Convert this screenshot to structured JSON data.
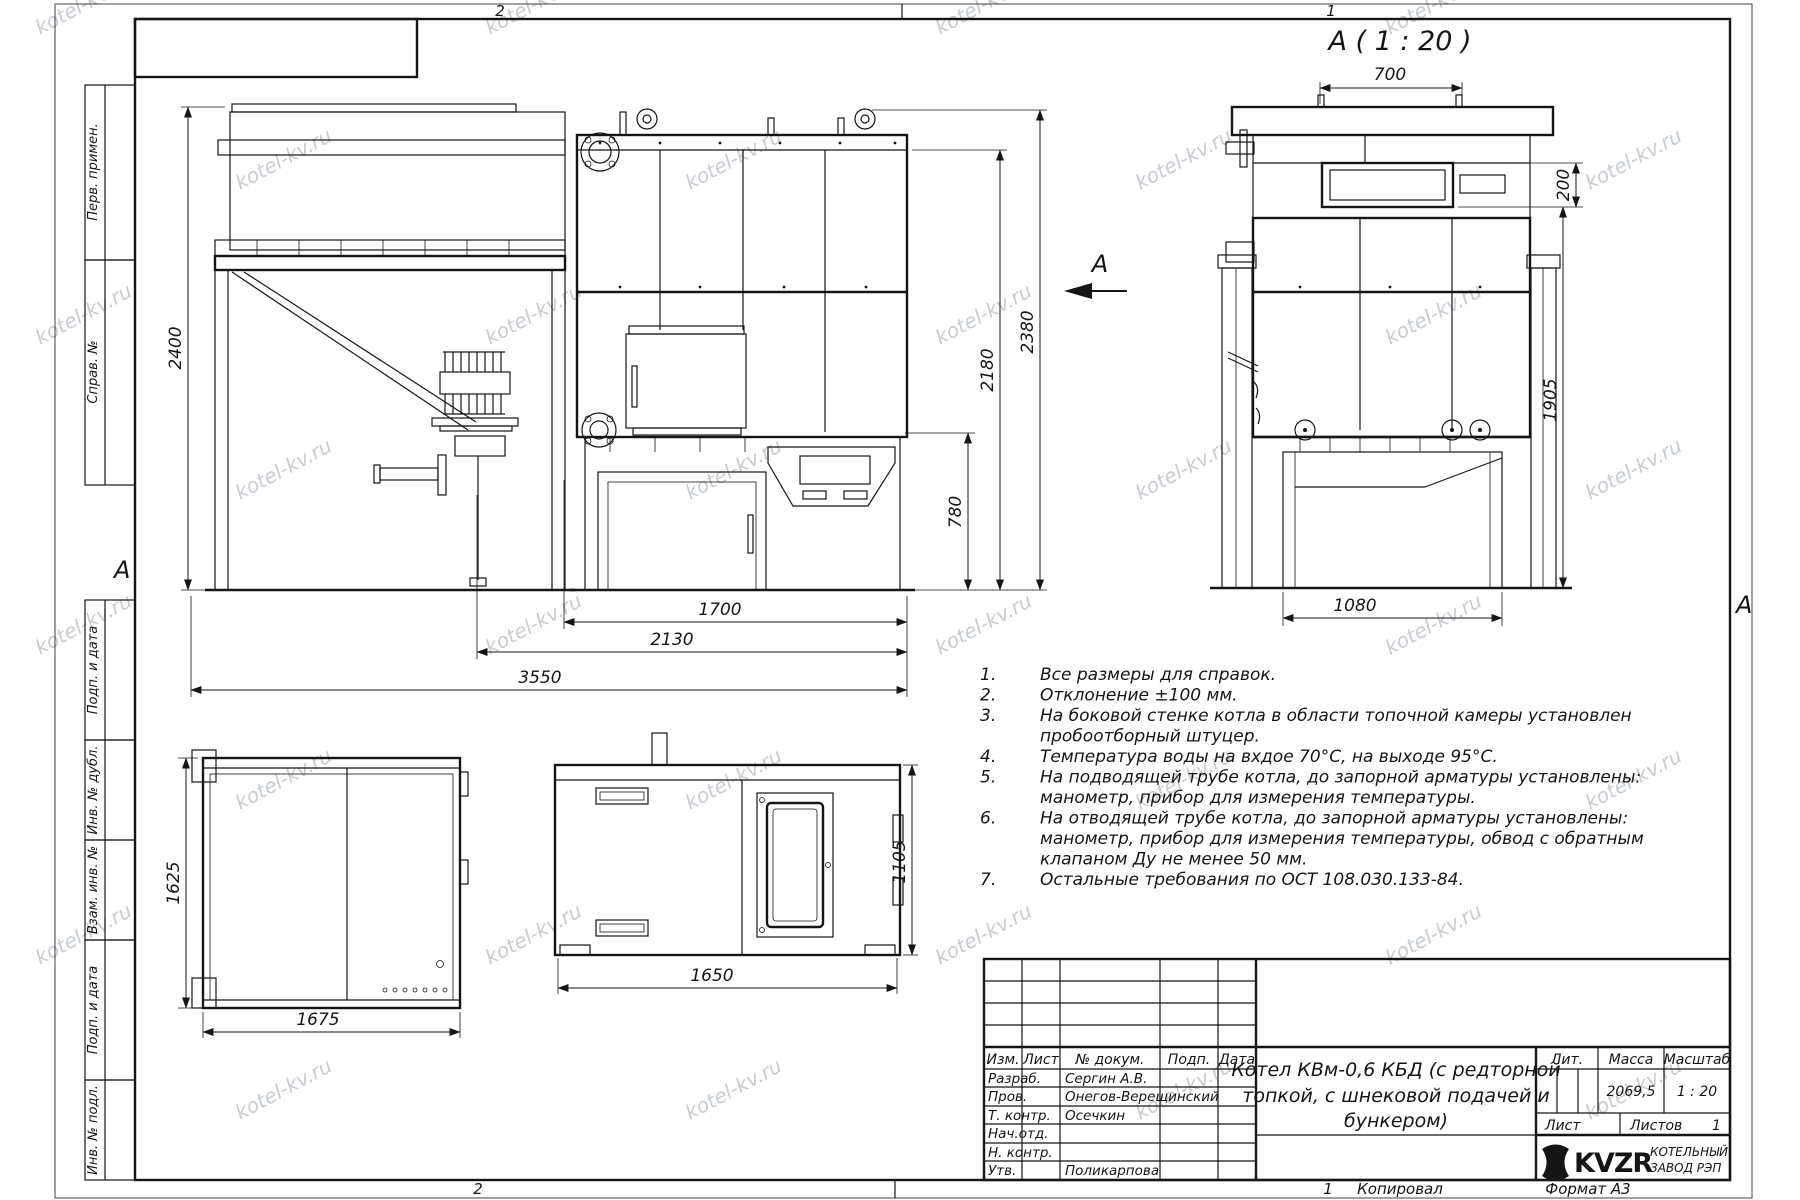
{
  "sheet": {
    "watermark": "kotel-kv.ru",
    "zones": {
      "z2": "2",
      "z1": "1",
      "a": "А"
    },
    "bottom_row": {
      "sheet_num": "1",
      "copied_label": "Копировал",
      "format_label": "Формат А3"
    }
  },
  "margin_stamps": [
    "Перв. примен.",
    "Справ. №",
    "Подп. и дата",
    "Инв. № дубл.",
    "Взам. инв. №",
    "Подп. и дата",
    "Инв. № подл."
  ],
  "view_label": "А ( 1 : 20 )",
  "view_arrow_label": "А",
  "dims": {
    "d2400": "2400",
    "d3550": "3550",
    "d2130": "2130",
    "d1700": "1700",
    "d780": "780",
    "d2180": "2180",
    "d2380": "2380",
    "d700": "700",
    "d200": "200",
    "d1905": "1905",
    "d1080": "1080",
    "d1625": "1625",
    "d1675": "1675",
    "d1105": "1105",
    "d1650": "1650"
  },
  "notes": [
    {
      "n": "1.",
      "lines": [
        "Все размеры для справок."
      ]
    },
    {
      "n": "2.",
      "lines": [
        "Отклонение ±100 мм."
      ]
    },
    {
      "n": "3.",
      "lines": [
        "На боковой стенке котла в области топочной камеры установлен",
        "пробоотборный штуцер."
      ]
    },
    {
      "n": "4.",
      "lines": [
        "Температура воды на вхдое 70°С, на выходе 95°С."
      ]
    },
    {
      "n": "5.",
      "lines": [
        "На подводящей трубе котла, до запорной арматуры установлены:",
        "манометр, прибор для измерения температуры."
      ]
    },
    {
      "n": "6.",
      "lines": [
        "На отводящей трубе котла, до запорной арматуры установлены:",
        "манометр, прибор для измерения температуры, обвод с обратным",
        "клапаном Ду не менее 50 мм."
      ]
    },
    {
      "n": "7.",
      "lines": [
        "Остальные требования по ОСТ 108.030.133-84."
      ]
    }
  ],
  "title_block": {
    "header": {
      "izm": "Изм.",
      "list": "Лист",
      "ndoc": "№ докум.",
      "podp": "Подп.",
      "data": "Дата"
    },
    "roles": [
      {
        "label": "Разраб.",
        "name": "Сергин А.В."
      },
      {
        "label": "Пров.",
        "name": "Онегов-Верещинский"
      },
      {
        "label": "Т. контр.",
        "name": "Осечкин"
      },
      {
        "label": "Нач.отд.",
        "name": ""
      },
      {
        "label": "Н. контр.",
        "name": ""
      },
      {
        "label": "Утв.",
        "name": "Поликарпова"
      }
    ],
    "doc_title_lines": [
      "Котел КВм-0,6 КБД (с редторной",
      "топкой, с шнековой подачей и",
      "бункером)"
    ],
    "lit_label": "Лит.",
    "mass_label": "Масса",
    "scale_label": "Масштаб",
    "mass_value": "2069,5",
    "scale_value": "1 : 20",
    "list_label": "Лист",
    "listov_label": "Листов",
    "listov_value": "1",
    "brand": "KVZR",
    "brand_line1": "КОТЕЛЬНЫЙ",
    "brand_line2": "ЗАВОД РЭП"
  }
}
